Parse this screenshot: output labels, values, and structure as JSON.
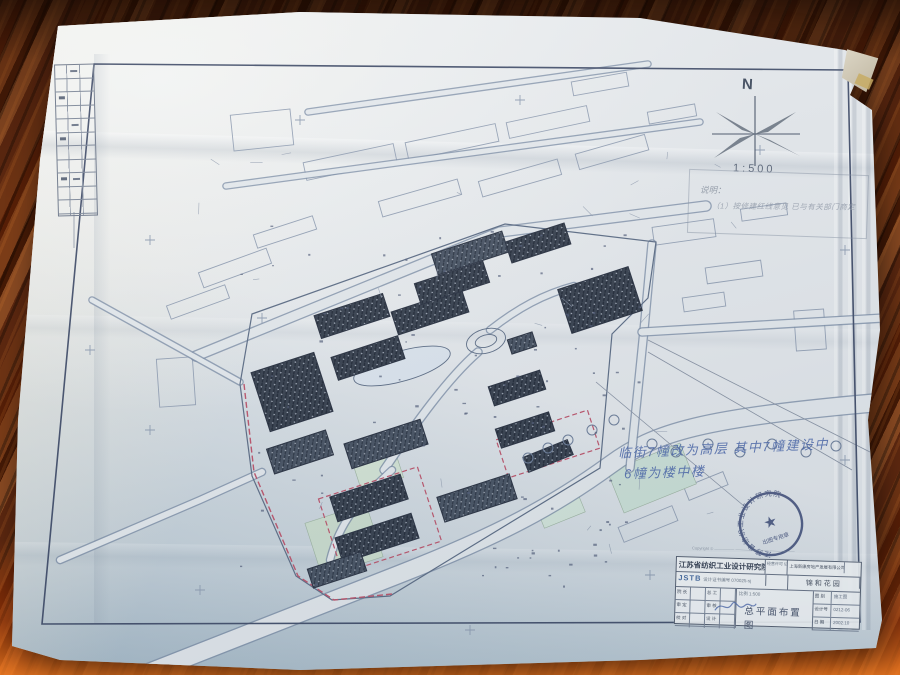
{
  "photo": {
    "scene": "blueprint site plan on wooden desk",
    "wood_base": "#5d2810",
    "wood_highlight": "#ff8223",
    "paper_color": "#e7eaed"
  },
  "sheet": {
    "frame_color": "#45506b",
    "legend": {
      "rows": 11,
      "cols": 3
    },
    "compass": {
      "label": "N",
      "scale": "1:500"
    },
    "notes": {
      "pencil_title": "说明：",
      "pencil_line": "（1）按修建红线意见 已与有关部门商定",
      "blue_line1": "临街7幢改为高层 其中7幢建设中",
      "blue_line2": "6幢为楼中楼"
    },
    "stamp": {
      "ring_text": "江苏省纺织工业设计研究院",
      "center_glyph": "★",
      "banner": "出图专用章"
    },
    "copyright": "Copyright © ————— ———— ———— ————  ——",
    "title_block": {
      "institute": "江苏省纺织工业设计研究院",
      "institute_code": "JSTB",
      "cert_line": "设计证书编号 070025-sj",
      "permit_label": "经营许可 证号",
      "client": "上海新康房地产发展有限公司南京分公司",
      "project": "锦和花园",
      "signature_rows": [
        [
          "院 长",
          "总 工"
        ],
        [
          "审 定",
          "审 核"
        ],
        [
          "校 对",
          "设 计"
        ]
      ],
      "scale_label": "比例 1:500",
      "drawing_title": "总平面布置图",
      "info_rows": [
        [
          "图 别",
          "施工图"
        ],
        [
          "设计号",
          "0212-06"
        ],
        [
          "日 期",
          "2002.10"
        ]
      ]
    }
  },
  "site_plan": {
    "colors": {
      "line": "#5f6e86",
      "light_line": "#97a3b6",
      "road_casing": "#8090a8",
      "road_fill": "#e7ebee",
      "building_dark": "#39414e",
      "building_mid": "#4a5463",
      "red": "#c0556b",
      "green1": "#cfe0cf",
      "green2": "#cfe3d8",
      "pond": "#dfe7ef"
    },
    "border_frame": "94,64 848,70 860,622 42,624",
    "boundary": "M252,314 L505,224 L656,242 L648,298 L612,334 L600,468 L462,552 L390,596 L332,600 L296,576 L252,476 L240,384 Z",
    "red_paths": [
      "M244,384 L254,472 L298,576 L334,600 L392,594"
    ],
    "red_rects": [
      {
        "cx": 380,
        "cy": 520,
        "w": 104,
        "h": 78,
        "rot": -18
      },
      {
        "cx": 548,
        "cy": 444,
        "w": 96,
        "h": 40,
        "rot": -18
      }
    ],
    "roads": [
      {
        "d": "M150,672 L400,574 C500,535 555,505 610,465 C655,432 700,418 885,402",
        "w": 17
      },
      {
        "d": "M196,356 L500,232 L706,206",
        "w": 9
      },
      {
        "d": "M652,244 L644,330 L630,468",
        "w": 7
      },
      {
        "d": "M642,332 L884,318",
        "w": 7
      },
      {
        "d": "M262,472 L200,500 L60,560",
        "w": 6
      },
      {
        "d": "M308,112 L648,64",
        "w": 5
      },
      {
        "d": "M226,186 L700,122",
        "w": 5
      },
      {
        "d": "M92,300 L240,382",
        "w": 5
      },
      {
        "d": "M478,352 C448,378 415,424 384,470",
        "w": 7
      },
      {
        "d": "M490,330 C518,308 544,294 574,286",
        "w": 6
      },
      {
        "d": "M392,470 C360,500 340,520 330,560",
        "w": 6
      }
    ],
    "greens": [
      {
        "cx": 344,
        "cy": 540,
        "w": 64,
        "h": 56,
        "rot": -18,
        "fill": "#cfe0cf"
      },
      {
        "cx": 378,
        "cy": 470,
        "w": 44,
        "h": 30,
        "rot": -18,
        "fill": "#d7e6d6"
      },
      {
        "cx": 652,
        "cy": 478,
        "w": 78,
        "h": 44,
        "rot": -22,
        "fill": "#cfe3d8"
      },
      {
        "cx": 560,
        "cy": 508,
        "w": 44,
        "h": 26,
        "rot": -22,
        "fill": "#d7e8dc"
      }
    ],
    "buildings": [
      {
        "cx": 292,
        "cy": 392,
        "w": 66,
        "h": 62,
        "rot": -18
      },
      {
        "cx": 300,
        "cy": 452,
        "w": 62,
        "h": 26,
        "rot": -18
      },
      {
        "cx": 352,
        "cy": 316,
        "w": 72,
        "h": 24,
        "rot": -18
      },
      {
        "cx": 368,
        "cy": 358,
        "w": 70,
        "h": 24,
        "rot": -18
      },
      {
        "cx": 386,
        "cy": 444,
        "w": 80,
        "h": 26,
        "rot": -18
      },
      {
        "cx": 430,
        "cy": 312,
        "w": 74,
        "h": 24,
        "rot": -18
      },
      {
        "cx": 452,
        "cy": 283,
        "w": 72,
        "h": 22,
        "rot": -18
      },
      {
        "cx": 470,
        "cy": 253,
        "w": 74,
        "h": 22,
        "rot": -18
      },
      {
        "cx": 538,
        "cy": 243,
        "w": 62,
        "h": 22,
        "rot": -18
      },
      {
        "cx": 600,
        "cy": 300,
        "w": 74,
        "h": 46,
        "rot": -18
      },
      {
        "cx": 522,
        "cy": 343,
        "w": 26,
        "h": 15,
        "rot": -18
      },
      {
        "cx": 517,
        "cy": 388,
        "w": 54,
        "h": 20,
        "rot": -18
      },
      {
        "cx": 525,
        "cy": 430,
        "w": 56,
        "h": 20,
        "rot": -18
      },
      {
        "cx": 477,
        "cy": 498,
        "w": 76,
        "h": 26,
        "rot": -18
      },
      {
        "cx": 369,
        "cy": 498,
        "w": 74,
        "h": 26,
        "rot": -18
      },
      {
        "cx": 377,
        "cy": 538,
        "w": 80,
        "h": 26,
        "rot": -18
      },
      {
        "cx": 337,
        "cy": 570,
        "w": 56,
        "h": 20,
        "rot": -18
      },
      {
        "cx": 548,
        "cy": 456,
        "w": 48,
        "h": 16,
        "rot": -22
      }
    ],
    "context_buildings": [
      {
        "cx": 350,
        "cy": 162,
        "w": 92,
        "h": 18,
        "rot": -12
      },
      {
        "cx": 452,
        "cy": 142,
        "w": 92,
        "h": 18,
        "rot": -12
      },
      {
        "cx": 548,
        "cy": 122,
        "w": 82,
        "h": 16,
        "rot": -12
      },
      {
        "cx": 420,
        "cy": 198,
        "w": 82,
        "h": 16,
        "rot": -16
      },
      {
        "cx": 520,
        "cy": 178,
        "w": 82,
        "h": 16,
        "rot": -16
      },
      {
        "cx": 612,
        "cy": 152,
        "w": 72,
        "h": 16,
        "rot": -16
      },
      {
        "cx": 235,
        "cy": 268,
        "w": 72,
        "h": 16,
        "rot": -20
      },
      {
        "cx": 198,
        "cy": 302,
        "w": 62,
        "h": 14,
        "rot": -20
      },
      {
        "cx": 285,
        "cy": 232,
        "w": 62,
        "h": 14,
        "rot": -18
      },
      {
        "cx": 684,
        "cy": 232,
        "w": 62,
        "h": 18,
        "rot": -8
      },
      {
        "cx": 734,
        "cy": 272,
        "w": 56,
        "h": 16,
        "rot": -8
      },
      {
        "cx": 704,
        "cy": 302,
        "w": 42,
        "h": 14,
        "rot": -8
      },
      {
        "cx": 764,
        "cy": 212,
        "w": 46,
        "h": 12,
        "rot": -8
      },
      {
        "cx": 648,
        "cy": 524,
        "w": 58,
        "h": 16,
        "rot": -22
      },
      {
        "cx": 706,
        "cy": 486,
        "w": 42,
        "h": 14,
        "rot": -22
      },
      {
        "cx": 262,
        "cy": 130,
        "w": 60,
        "h": 36,
        "rot": -6
      },
      {
        "cx": 600,
        "cy": 84,
        "w": 56,
        "h": 14,
        "rot": -10
      },
      {
        "cx": 672,
        "cy": 114,
        "w": 48,
        "h": 12,
        "rot": -10
      },
      {
        "cx": 176,
        "cy": 382,
        "w": 36,
        "h": 48,
        "rot": -4
      },
      {
        "cx": 810,
        "cy": 330,
        "w": 30,
        "h": 40,
        "rot": -4
      }
    ],
    "pond": {
      "cx": 402,
      "cy": 366,
      "rx": 50,
      "ry": 15,
      "rot": -16
    },
    "loop": [
      {
        "cx": 486,
        "cy": 341,
        "rx": 20,
        "ry": 12
      },
      {
        "cx": 486,
        "cy": 341,
        "rx": 11,
        "ry": 6
      }
    ],
    "trees": [
      [
        528,
        458
      ],
      [
        548,
        448
      ],
      [
        568,
        440
      ],
      [
        592,
        430
      ],
      [
        614,
        420
      ],
      [
        652,
        444
      ],
      [
        676,
        452
      ],
      [
        708,
        444
      ],
      [
        740,
        452
      ],
      [
        772,
        444
      ],
      [
        806,
        452
      ],
      [
        836,
        446
      ]
    ],
    "crosses": [
      [
        150,
        240
      ],
      [
        150,
        430
      ],
      [
        300,
        120
      ],
      [
        520,
        100
      ],
      [
        760,
        150
      ],
      [
        845,
        250
      ],
      [
        845,
        460
      ],
      [
        200,
        590
      ],
      [
        470,
        630
      ],
      [
        650,
        575
      ],
      [
        90,
        350
      ],
      [
        262,
        318
      ]
    ],
    "extra_lines": [
      [
        596,
        382,
        744,
        506
      ],
      [
        648,
        340,
        870,
        452
      ],
      [
        648,
        352,
        852,
        470
      ],
      [
        74,
        212,
        74,
        248
      ]
    ],
    "compass": {
      "cx": 755,
      "cy": 134,
      "v": [
        755,
        96,
        755,
        166
      ],
      "h": [
        712,
        134,
        800,
        134
      ],
      "blades": [
        "755,134 796,112 768,132",
        "755,134 800,156 770,140",
        "755,134 714,158 740,138",
        "755,134 716,112 742,130"
      ]
    }
  }
}
